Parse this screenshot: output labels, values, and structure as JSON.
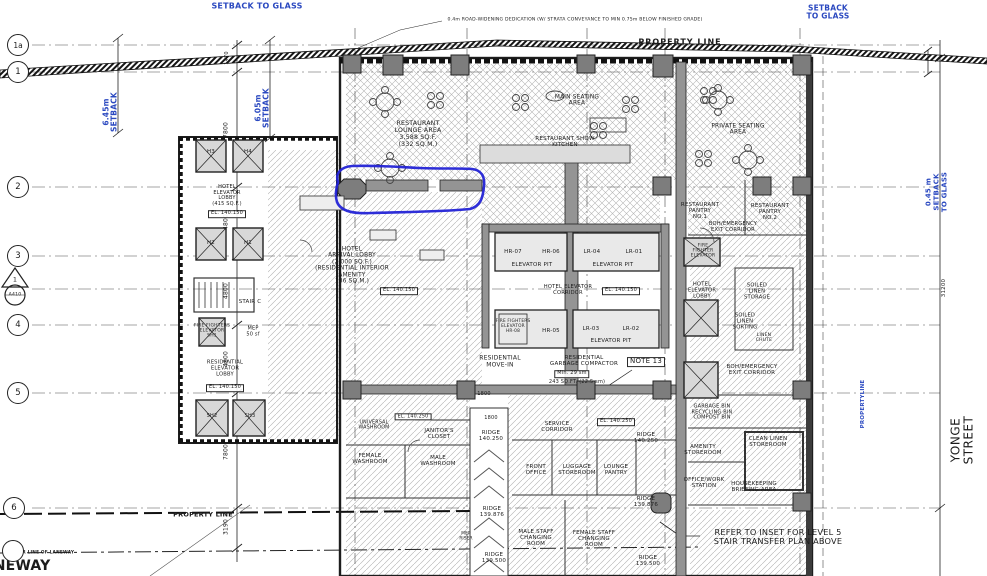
{
  "colors": {
    "annotation_blue": "#2323d6",
    "note_blue": "#2b49c0",
    "ink": "#1c1c1c",
    "wall_gray": "#949494",
    "dark_wall": "#3c3c3c"
  },
  "grid": {
    "bubbles": [
      {
        "label": "1a",
        "x": 18,
        "y": 45,
        "fs": 7.5
      },
      {
        "label": "1",
        "x": 18,
        "y": 72,
        "fs": 8.5
      },
      {
        "label": "2",
        "x": 18,
        "y": 187,
        "fs": 8.5
      },
      {
        "label": "3",
        "x": 18,
        "y": 256,
        "fs": 8.5
      },
      {
        "label": "4",
        "x": 18,
        "y": 325,
        "fs": 8.5
      },
      {
        "label": "5",
        "x": 18,
        "y": 393,
        "fs": 8.5
      },
      {
        "label": "6",
        "x": 14,
        "y": 508,
        "fs": 8.5
      },
      {
        "label": "",
        "x": 13,
        "y": 551,
        "fs": 8
      }
    ],
    "section_marker": {
      "number": "1",
      "sheet": "A410"
    }
  },
  "labels": [
    {
      "name": "setback-to-glass-top-left",
      "text": "SETBACK TO GLASS",
      "x": 257,
      "y": 7,
      "fs": 8,
      "color": "blue",
      "bold": true
    },
    {
      "name": "setback-to-glass-top-right",
      "text": "SETBACK\nTO GLASS",
      "x": 828,
      "y": 13,
      "fs": 7.5,
      "color": "blue",
      "bold": true
    },
    {
      "name": "road-widening-note",
      "text": "0.4m ROAD-WIDENING DEDICATION (W/ STRATA CONVEYANCE TO MIN 0.75m BELOW FINISHED GRADE)",
      "x": 575,
      "y": 20,
      "fs": 4.6
    },
    {
      "name": "property-line-top",
      "text": "PROPERTY LINE",
      "x": 680,
      "y": 43,
      "fs": 8,
      "bold": true,
      "ls": 1
    },
    {
      "name": "setback-645",
      "text": "6.45m\nSETBACK",
      "x": 111,
      "y": 112,
      "fs": 7.5,
      "rot": -90,
      "color": "blue",
      "bold": true
    },
    {
      "name": "setback-605",
      "text": "6.05m\nSETBACK",
      "x": 263,
      "y": 108,
      "fs": 7.5,
      "rot": -90,
      "color": "blue",
      "bold": true
    },
    {
      "name": "setback-045",
      "text": "0.45 m\nSETBACK\nTO GLASS",
      "x": 937,
      "y": 192,
      "fs": 7,
      "rot": -90,
      "color": "blue",
      "bold": true
    },
    {
      "name": "property-line-right",
      "text": "PROPERTYLINE",
      "x": 863,
      "y": 404,
      "fs": 5.5,
      "rot": -90,
      "color": "blue",
      "bold": true
    },
    {
      "name": "yonge-street",
      "text": "YONGE STREET",
      "x": 963,
      "y": 440,
      "fs": 12,
      "rot": -90,
      "ls": 0.5
    },
    {
      "name": "dim-1470",
      "text": "1470",
      "x": 228,
      "y": 58,
      "fs": 5,
      "rot": -90
    },
    {
      "name": "dim-7800-a",
      "text": "7800",
      "x": 227,
      "y": 130,
      "fs": 6,
      "rot": -90
    },
    {
      "name": "dim-4800-a",
      "text": "4800",
      "x": 227,
      "y": 222,
      "fs": 6,
      "rot": -90
    },
    {
      "name": "dim-4800-b",
      "text": "4800",
      "x": 227,
      "y": 291,
      "fs": 6,
      "rot": -90
    },
    {
      "name": "dim-4800-c",
      "text": "4800",
      "x": 227,
      "y": 359,
      "fs": 6,
      "rot": -90
    },
    {
      "name": "dim-7800-b",
      "text": "7800",
      "x": 227,
      "y": 452,
      "fs": 6,
      "rot": -90
    },
    {
      "name": "dim-3190",
      "text": "3190",
      "x": 227,
      "y": 527,
      "fs": 6,
      "rot": -90
    },
    {
      "name": "dim-31200",
      "text": "31200",
      "x": 944,
      "y": 288,
      "fs": 5.5,
      "rot": -90
    },
    {
      "name": "restaurant-lounge-area",
      "text": "RESTAURANT\nLOUNGE AREA\n3,588 SQ.F.\n(332 SQ.M.)",
      "x": 418,
      "y": 135,
      "fs": 6.2
    },
    {
      "name": "main-seating-area",
      "text": "MAIN SEATING\nAREA",
      "x": 577,
      "y": 101,
      "fs": 5.8
    },
    {
      "name": "restaurant-show-kitchen",
      "text": "RESTAURANT SHOW\nKITCHEN",
      "x": 565,
      "y": 142,
      "fs": 5.6
    },
    {
      "name": "private-seating-area",
      "text": "PRIVATE SEATING\nAREA",
      "x": 738,
      "y": 130,
      "fs": 5.8
    },
    {
      "name": "hotel-elevator-lobby-left",
      "text": "HOTEL\nELEVATOR\nLOBBY\n(415 SQ.F.)",
      "x": 227,
      "y": 196,
      "fs": 5
    },
    {
      "name": "el-140150-left-lobby",
      "text": "EL. 140.150",
      "x": 227,
      "y": 214,
      "fs": 5,
      "box": true
    },
    {
      "name": "elevator-h3",
      "text": "H3",
      "x": 211,
      "y": 152,
      "fs": 5.5
    },
    {
      "name": "elevator-h4",
      "text": "H4",
      "x": 248,
      "y": 152,
      "fs": 5.5
    },
    {
      "name": "elevator-h2",
      "text": "H2",
      "x": 211,
      "y": 243,
      "fs": 5.5
    },
    {
      "name": "elevator-h1",
      "text": "H1",
      "x": 248,
      "y": 243,
      "fs": 5.5
    },
    {
      "name": "stair-c",
      "text": "STAIR C",
      "x": 250,
      "y": 302,
      "fs": 5.5
    },
    {
      "name": "hotel-arrival-lobby",
      "text": "HOTEL\nARRIVAL LOBBY\n(2,000 SQ.F.)\n(RESIDENTIAL INTERIOR\nAMENITY\n186 SQ.M.)",
      "x": 352,
      "y": 266,
      "fs": 5.8
    },
    {
      "name": "el-140150-arrival",
      "text": "EL. 140.150",
      "x": 399,
      "y": 291,
      "fs": 5,
      "box": true
    },
    {
      "name": "fire-fighters-elevator-sh1",
      "text": "FIRE FIGHTERS\nELEVATOR\nSH1",
      "x": 212,
      "y": 331,
      "fs": 4.5
    },
    {
      "name": "mep-50sf",
      "text": "MEP\n50 sf",
      "x": 253,
      "y": 332,
      "fs": 5
    },
    {
      "name": "residential-elevator-lobby",
      "text": "RESIDENTIAL\nELEVATOR\nLOBBY",
      "x": 225,
      "y": 369,
      "fs": 5.2
    },
    {
      "name": "el-140150-res-lobby",
      "text": "EL. 140.150",
      "x": 225,
      "y": 388,
      "fs": 5,
      "box": true
    },
    {
      "name": "elevator-sh2",
      "text": "SH2",
      "x": 212,
      "y": 417,
      "fs": 5
    },
    {
      "name": "elevator-sh3",
      "text": "SH3",
      "x": 250,
      "y": 417,
      "fs": 5
    },
    {
      "name": "elevator-hr07",
      "text": "HR-07",
      "x": 513,
      "y": 252,
      "fs": 5.5
    },
    {
      "name": "elevator-hr06",
      "text": "HR-06",
      "x": 551,
      "y": 252,
      "fs": 5.5
    },
    {
      "name": "elevator-pit-1",
      "text": "ELEVATOR PIT",
      "x": 532,
      "y": 265,
      "fs": 5.5
    },
    {
      "name": "elevator-lr04",
      "text": "LR-04",
      "x": 592,
      "y": 252,
      "fs": 5.5
    },
    {
      "name": "elevator-lr01",
      "text": "LR-01",
      "x": 634,
      "y": 252,
      "fs": 5.5
    },
    {
      "name": "elevator-pit-2",
      "text": "ELEVATOR PIT",
      "x": 613,
      "y": 265,
      "fs": 5.5
    },
    {
      "name": "hotel-elevator-corridor",
      "text": "HOTEL ELEVATOR\nCORRIDOR",
      "x": 568,
      "y": 291,
      "fs": 5.2
    },
    {
      "name": "el-140150-corridor",
      "text": "EL. 140.150",
      "x": 621,
      "y": 291,
      "fs": 5,
      "box": true
    },
    {
      "name": "fire-fighters-elevator-hr08",
      "text": "FIRE FIGHTERS\nELEVATOR\nHR-08",
      "x": 513,
      "y": 327,
      "fs": 4.3
    },
    {
      "name": "elevator-hr05",
      "text": "HR-05",
      "x": 551,
      "y": 331,
      "fs": 5.5
    },
    {
      "name": "elevator-lr03",
      "text": "LR-03",
      "x": 591,
      "y": 329,
      "fs": 5.5
    },
    {
      "name": "elevator-lr02",
      "text": "LR-02",
      "x": 631,
      "y": 329,
      "fs": 5.5
    },
    {
      "name": "elevator-pit-3",
      "text": "ELEVATOR PIT",
      "x": 611,
      "y": 341,
      "fs": 5.5
    },
    {
      "name": "residential-move-in",
      "text": "RESIDENTIAL\nMOVE-IN",
      "x": 500,
      "y": 362,
      "fs": 6
    },
    {
      "name": "residential-garbage-compactor",
      "text": "RESIDENTIAL\nGARBAGE COMPACTOR",
      "x": 584,
      "y": 361,
      "fs": 5.6
    },
    {
      "name": "note-13",
      "text": "NOTE 13",
      "x": 646,
      "y": 362,
      "fs": 7,
      "box": true
    },
    {
      "name": "min-29-sm",
      "text": "Min. 29 sm",
      "x": 572,
      "y": 374,
      "fs": 5,
      "box": true
    },
    {
      "name": "sqft-243",
      "text": "243 SQ.FT. (22.5 sm)",
      "x": 577,
      "y": 383,
      "fs": 5
    },
    {
      "name": "dim-1800-a",
      "text": "1800",
      "x": 484,
      "y": 395,
      "fs": 5
    },
    {
      "name": "dim-1800-b",
      "text": "1800",
      "x": 491,
      "y": 419,
      "fs": 5
    },
    {
      "name": "ridge-ramp-top",
      "text": "RIDGE\n140.250",
      "x": 491,
      "y": 436,
      "fs": 5.5
    },
    {
      "name": "service-corridor",
      "text": "SERVICE\nCORRIDOR",
      "x": 557,
      "y": 427,
      "fs": 5.5
    },
    {
      "name": "el-140250-mid",
      "text": "EL. 140.250",
      "x": 616,
      "y": 422,
      "fs": 5,
      "box": true
    },
    {
      "name": "ridge-right-top",
      "text": "RIDGE\n140.250",
      "x": 646,
      "y": 438,
      "fs": 5.5
    },
    {
      "name": "el-140250-left",
      "text": "EL. 140.250",
      "x": 413,
      "y": 417,
      "fs": 4.8,
      "box": true
    },
    {
      "name": "universal-washroom",
      "text": "UNIVERSAL\nWASHROOM",
      "x": 374,
      "y": 426,
      "fs": 4.8
    },
    {
      "name": "janitors-closet",
      "text": "JANITOR'S\nCLOSET",
      "x": 439,
      "y": 434,
      "fs": 5.5
    },
    {
      "name": "female-washroom",
      "text": "FEMALE\nWASHROOM",
      "x": 370,
      "y": 459,
      "fs": 5.5
    },
    {
      "name": "male-washroom",
      "text": "MALE\nWASHROOM",
      "x": 438,
      "y": 461,
      "fs": 5.5
    },
    {
      "name": "front-office",
      "text": "FRONT\nOFFICE",
      "x": 536,
      "y": 470,
      "fs": 5.5
    },
    {
      "name": "luggage-storeroom",
      "text": "LUGGAGE\nSTOREROOM",
      "x": 577,
      "y": 470,
      "fs": 5.5
    },
    {
      "name": "lounge-pantry",
      "text": "LOUNGE\nPANTRY",
      "x": 616,
      "y": 470,
      "fs": 5.5
    },
    {
      "name": "male-staff-changing",
      "text": "MALE STAFF\nCHANGING\nROOM",
      "x": 536,
      "y": 538,
      "fs": 5.5
    },
    {
      "name": "female-staff-changing",
      "text": "FEMALE STAFF\nCHANGING\nROOM",
      "x": 594,
      "y": 539,
      "fs": 5.5
    },
    {
      "name": "mep-riser",
      "text": "MEP\nRISER",
      "x": 466,
      "y": 536,
      "fs": 4.2
    },
    {
      "name": "ridge-139876-ramp",
      "text": "RIDGE\n139.876",
      "x": 492,
      "y": 512,
      "fs": 5.5
    },
    {
      "name": "ridge-139500-ramp",
      "text": "RIDGE\n139.500",
      "x": 494,
      "y": 558,
      "fs": 5.5
    },
    {
      "name": "ridge-139876-right",
      "text": "RIDGE\n139.876",
      "x": 646,
      "y": 502,
      "fs": 5.5
    },
    {
      "name": "ridge-139500-right",
      "text": "RIDGE\n139.500",
      "x": 648,
      "y": 561,
      "fs": 5.5
    },
    {
      "name": "restaurant-pantry-no1",
      "text": "RESTAURANT\nPANTRY\nNO.1",
      "x": 700,
      "y": 211,
      "fs": 5.5
    },
    {
      "name": "restaurant-pantry-no2",
      "text": "RESTAURANT\nPANTRY\nNO.2",
      "x": 770,
      "y": 212,
      "fs": 5.5
    },
    {
      "name": "boh-emergency-exit-top",
      "text": "BOH/EMERGENCY\nEXIT CORRIDOR",
      "x": 733,
      "y": 228,
      "fs": 5.2
    },
    {
      "name": "fire-fighter-elevator-right",
      "text": "FIRE\nFIGHTER\nELEVATOR",
      "x": 703,
      "y": 251,
      "fs": 4.5
    },
    {
      "name": "hotel-elevator-lobby-right",
      "text": "HOTEL\nELEVATOR\nLOBBY",
      "x": 702,
      "y": 291,
      "fs": 5.2
    },
    {
      "name": "soiled-linen-storage",
      "text": "SOILED\nLINEN\nSTORAGE",
      "x": 757,
      "y": 292,
      "fs": 5.2
    },
    {
      "name": "soiled-linen-sorting",
      "text": "SOILED\nLINEN\nSORTING",
      "x": 745,
      "y": 322,
      "fs": 5.2
    },
    {
      "name": "linen-chute",
      "text": "LINEN\nCHUTE",
      "x": 764,
      "y": 338,
      "fs": 4.5
    },
    {
      "name": "boh-emergency-exit-right",
      "text": "BOH/EMERGENCY\nEXIT CORRIDOR",
      "x": 752,
      "y": 370,
      "fs": 5.5
    },
    {
      "name": "garbage-recycling-bins",
      "text": "GARBAGE BIN\nRECYCLING BIN\nCOMPOST BIN",
      "x": 712,
      "y": 413,
      "fs": 5
    },
    {
      "name": "clean-linen-storeroom",
      "text": "CLEAN LINEN\nSTOREROOM",
      "x": 768,
      "y": 442,
      "fs": 5.5
    },
    {
      "name": "amenity-storeroom",
      "text": "AMENITY\nSTOREROOM",
      "x": 703,
      "y": 450,
      "fs": 5.5
    },
    {
      "name": "office-work-station",
      "text": "OFFICE/WORK\nSTATION",
      "x": 704,
      "y": 483,
      "fs": 5.5
    },
    {
      "name": "housekeeping-briefing-area",
      "text": "HOUSEKEEPING\nBRIEFING AREA",
      "x": 754,
      "y": 487,
      "fs": 5.5
    },
    {
      "name": "refer-to-inset-note",
      "text": "REFER TO INSET FOR LEVEL 5\nSTAIR TRANSFER PLAN ABOVE",
      "x": 778,
      "y": 537,
      "fs": 8.2
    },
    {
      "name": "property-line-bottom",
      "text": "PROPERTY LINE",
      "x": 203,
      "y": 515,
      "fs": 6.5,
      "bold": true
    },
    {
      "name": "center-line-of-laneway",
      "text": "CENTER LINE OF LANEWAY",
      "x": 40,
      "y": 554,
      "fs": 4.3,
      "bold": true
    },
    {
      "name": "laneway",
      "text": "LANEWAY",
      "x": 12,
      "y": 567,
      "fs": 14,
      "bold": true
    },
    {
      "name": "section-marker-number",
      "text": "1",
      "x": 15,
      "y": 280,
      "fs": 6.5
    },
    {
      "name": "section-marker-sheet",
      "text": "A410",
      "x": 15,
      "y": 295,
      "fs": 4.6
    }
  ]
}
